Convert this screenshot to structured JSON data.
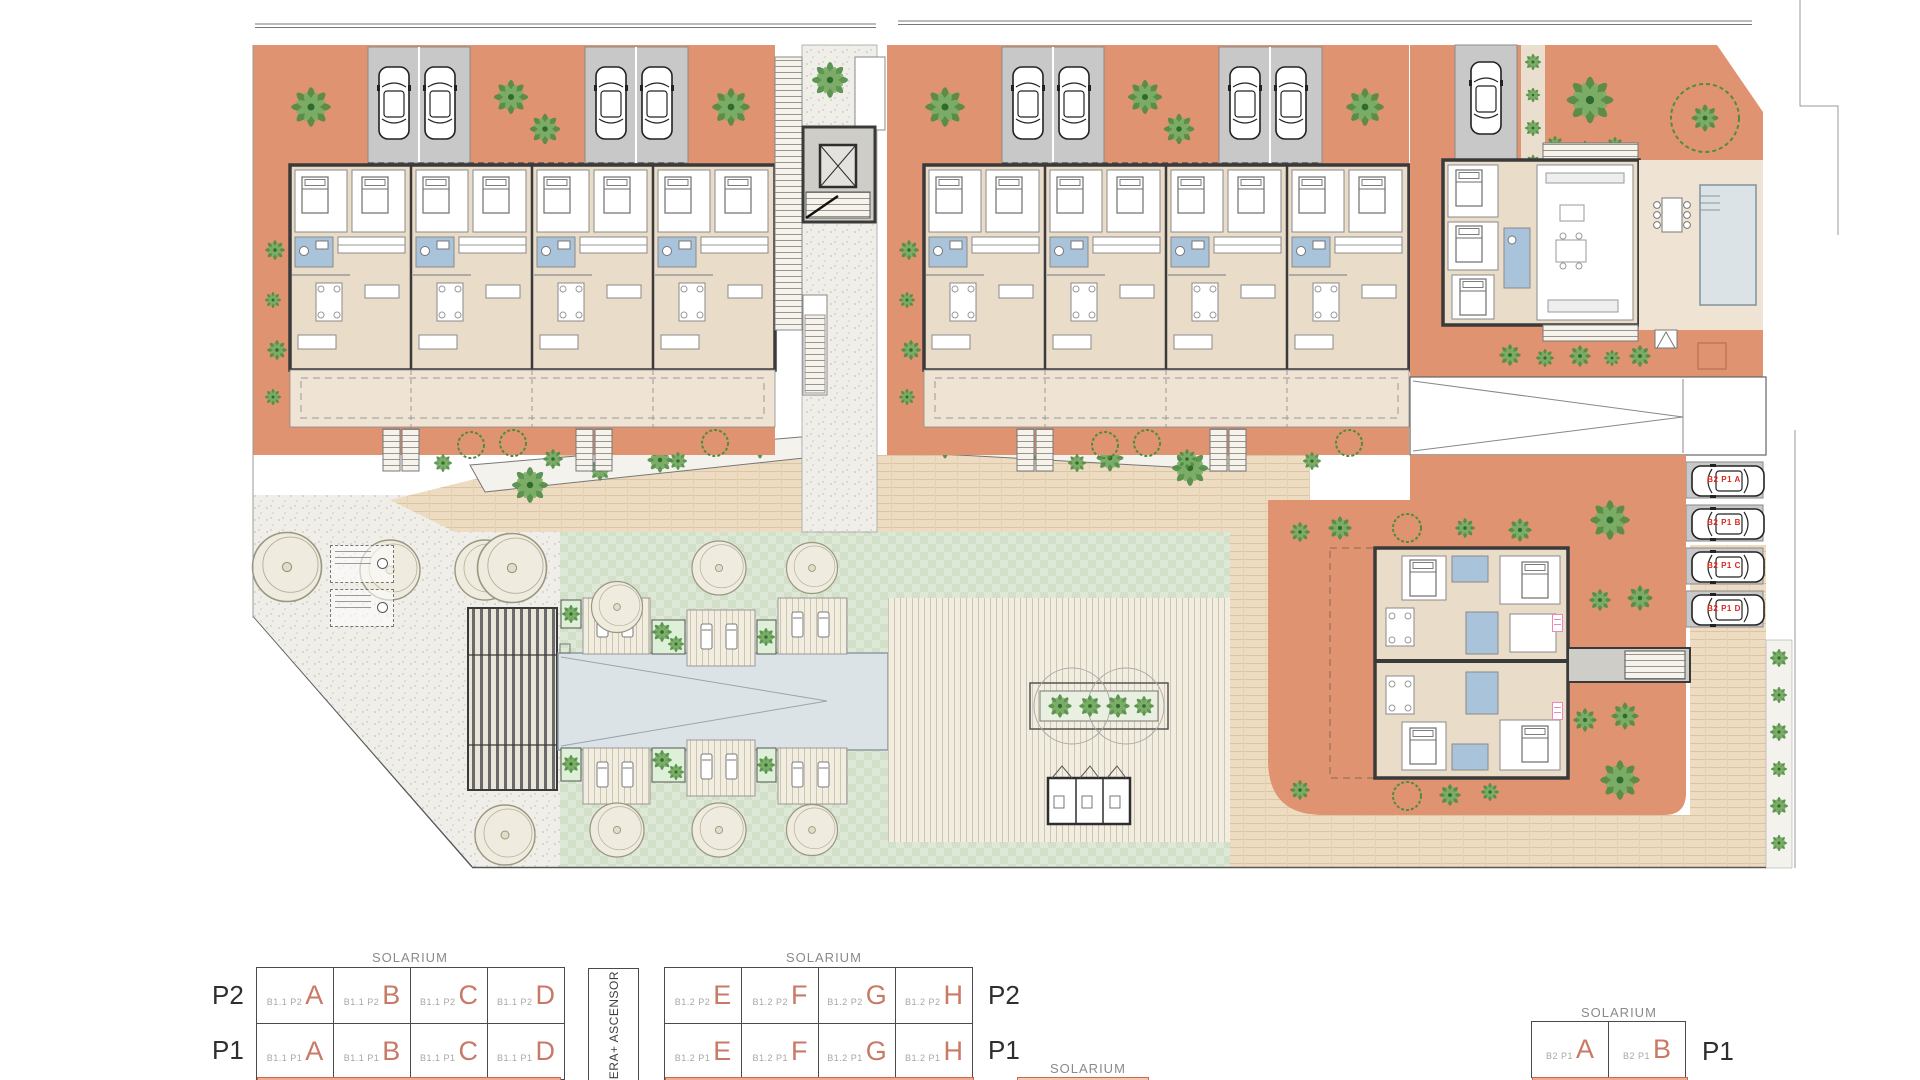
{
  "plan": {
    "parking_labels": [
      "B2 P1 A",
      "B2 P1 B",
      "B2 P1 C",
      "B2 P1 D"
    ]
  },
  "legend": {
    "solarium": "SOLARIUM",
    "core": "ESCALERA+ ASCENSOR",
    "p2": "P2",
    "p1": "P1",
    "b11": {
      "p2_prefix": "B1.1 P2",
      "p1_prefix": "B1.1 P1",
      "letters": [
        "A",
        "B",
        "C",
        "D"
      ]
    },
    "b12": {
      "p2_prefix": "B1.2 P2",
      "p1_prefix": "B1.2 P1",
      "letters": [
        "E",
        "F",
        "G",
        "H"
      ]
    },
    "b2": {
      "p1_prefix": "B2 P1",
      "letters": [
        "A",
        "B"
      ]
    }
  },
  "colors": {
    "terracotta": "#E09370",
    "floor_beige": "#E9DCC9",
    "terrace_beige": "#EFE4D4",
    "garage_gray": "#C8C8C8",
    "bath_blue": "#A9C3DA",
    "pool": "#DBE3E6",
    "lawn": "#DCE7D6",
    "plant_green": "#4E8C44",
    "wall_dark": "#3A3A3A",
    "parking_label_red": "#D42B1F",
    "legend_letter_salmon": "#C97A67",
    "solarium_strip": "#F2A98C"
  }
}
